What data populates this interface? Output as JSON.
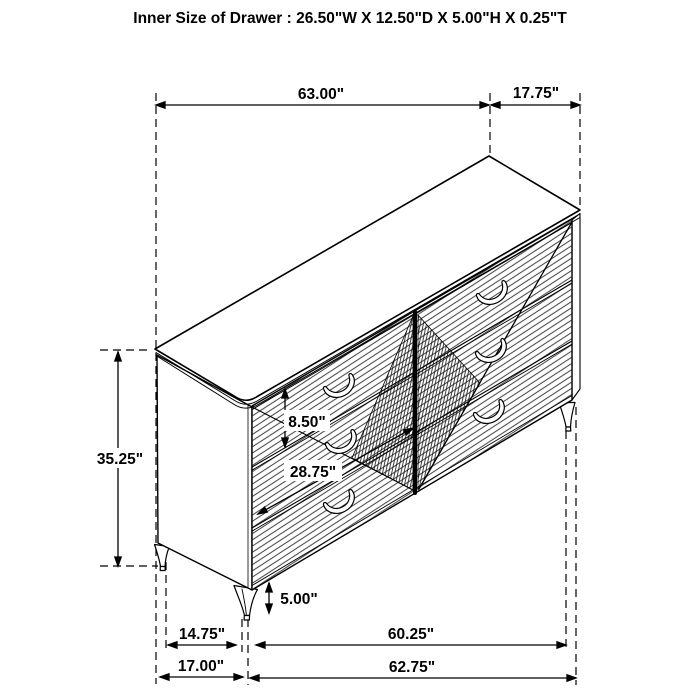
{
  "title": "Inner Size of Drawer : 26.50\"W X 12.50\"D X 5.00\"H X 0.25\"T",
  "dims": {
    "top_width": "63.00\"",
    "top_depth": "17.75\"",
    "overall_height": "35.25\"",
    "drawer_front_height": "8.50\"",
    "drawer_front_width": "28.75\"",
    "leg_height": "5.00\"",
    "side_leg_span_inner": "14.75\"",
    "side_depth_outer": "17.00\"",
    "front_leg_span_inner": "60.25\"",
    "front_width_outer": "62.75\""
  },
  "colors": {
    "line": "#000000",
    "background": "#ffffff"
  }
}
